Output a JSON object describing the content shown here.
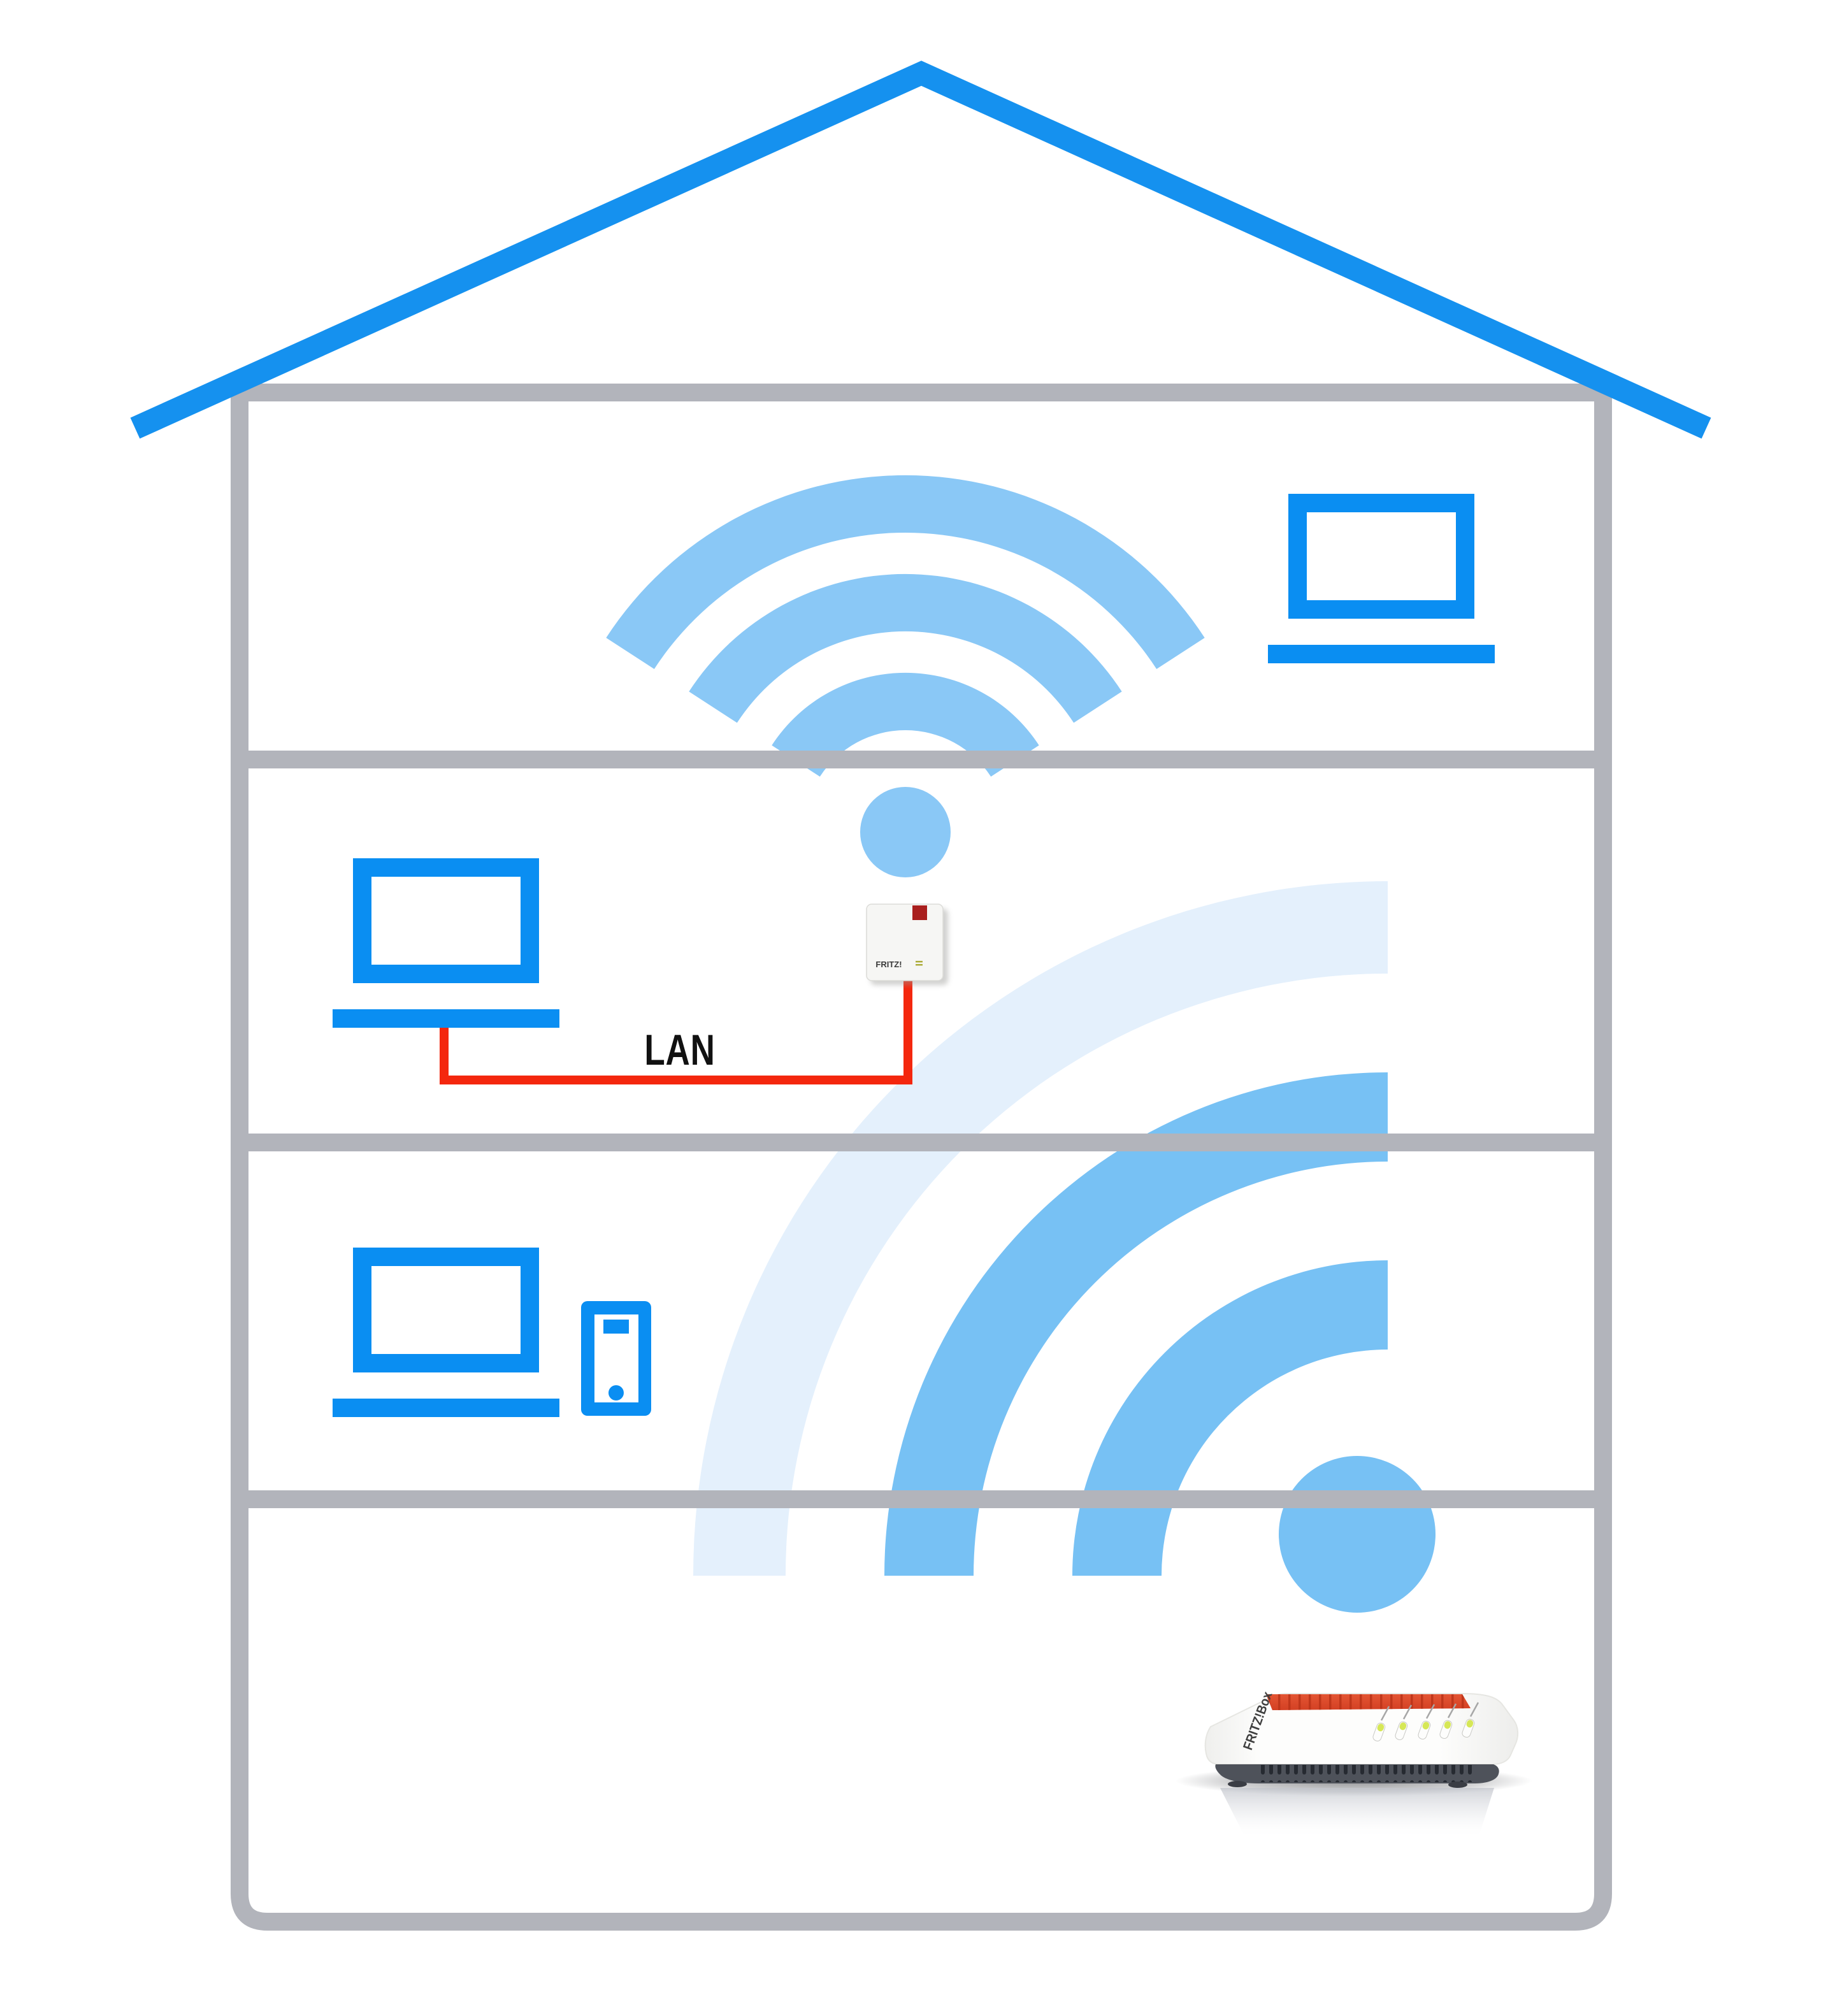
{
  "diagram": {
    "lan_label": "LAN",
    "repeater": {
      "brand_label": "FRITZ!"
    },
    "router": {
      "brand_label": "FRITZ!Box",
      "led_count": 5
    },
    "floors": 4,
    "devices": [
      "laptop-top-floor",
      "laptop-second-floor",
      "repeater",
      "laptop-third-floor",
      "smartphone",
      "router"
    ]
  },
  "colors": {
    "roof_blue": "#1591EF",
    "device_blue": "#0A8EF2",
    "structure_gray": "#B2B4BB",
    "wifi_light_blue": "#8AC8F6",
    "wifi_medium_blue": "#77C1F4",
    "wifi_pale_blue": "#E4F0FC",
    "lan_cable_red": "#F4270E",
    "led_dark_red": "#A91F1E",
    "router_red": "#DC472A",
    "led_green": "#D6E757",
    "label_black": "#111111",
    "repeater_body": "#F6F6F4",
    "router_base_gray": "#4E525A"
  }
}
